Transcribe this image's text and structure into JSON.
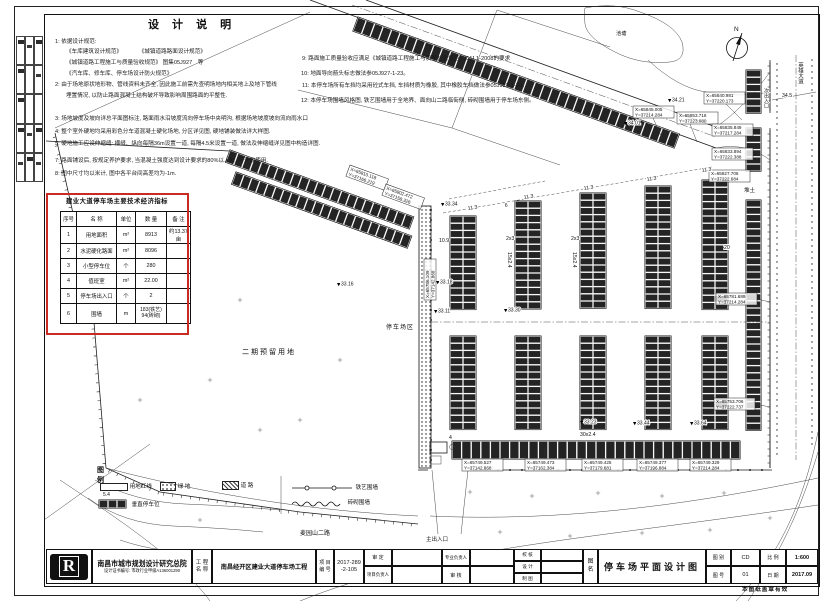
{
  "design_notes": {
    "title": "设 计 说 明",
    "left": [
      "1: 依据设计规范:",
      "《车库建筑设计规范》　　　　《城镇道路路面设计规范》",
      "《城镇道路工程施工与质量验收规范》 图集05J927　等",
      "《汽车库、修车库、停车场设计防火规范》",
      "2: 由于场地原状地形物、管线资料未齐全, 因此施工前需先查明场地内相关地上及地下管线",
      "埋置情况, 以防止路面混凝土结构破坏导致影响周围路面的平整性.",
      "3: 场地坡度及坡向详总平面图标注, 路面雨水沿坡度流向停车场中央明沟, 根据场地坡度坡向流向雨水口",
      "4: 整个室外硬地均采用彩色分车道混凝土硬化场地, 分区详见图, 硬地铺装做法详大样图.",
      "5: 硬地施工应设伸缩缝: 横缝、纵向每隔36m设置一道, 每隔4.5米设置一道, 做法及伸缩缝详见图中构造详图.",
      "7: 路面铺设后, 按规定养护要求, 当混凝土强度达到设计要求的80%以上时, 可开放使用.",
      "8: 图中尺寸均以米计, 图中各平台间高差均为-1m."
    ],
    "right": [
      "9: 路面施工质量验收应满足《城镇道路工程施工与质量验收规范》CJJ 1-2008的要求",
      "10: 地面导向箭头标志做法参05J927-1-23。",
      "11: 本停车场所有车挡均采用砼式车挡, 车挡材质为橡胶, 其中橡胶车挡做法参05J927-1-30。",
      "12: 本停车场围墙风格图, 铁艺围墙用于全地界、面向山二路临街侧, 砖砌围墙用于停车场东侧。"
    ]
  },
  "indicators": {
    "title": "建业大道停车场主要技术经济指标",
    "headers": [
      "序号",
      "名  称",
      "单位",
      "数 量",
      "备 注"
    ],
    "rows": [
      {
        "no": "1",
        "name": "用地面积",
        "unit": "m²",
        "qty": "8913",
        "qty2": "",
        "remark": "约13.37亩"
      },
      {
        "no": "2",
        "name": "水泥硬化路面",
        "unit": "m²",
        "qty": "8096",
        "qty2": "",
        "remark": ""
      },
      {
        "no": "3",
        "name": "小型停车位",
        "unit": "个",
        "qty": "280",
        "qty2": "",
        "remark": ""
      },
      {
        "no": "4",
        "name": "值班室",
        "unit": "m²",
        "qty": "22.00",
        "qty2": "",
        "remark": ""
      },
      {
        "no": "5",
        "name": "停车场出入口",
        "unit": "个",
        "qty": "2",
        "qty2": "",
        "remark": ""
      },
      {
        "no": "6",
        "name": "围墙",
        "unit": "m",
        "qty": "183(铁艺)",
        "qty2": "94(砖砌)",
        "remark": ""
      }
    ]
  },
  "legend": {
    "title": "图 例",
    "redline": "用地红线",
    "green": "绿  地",
    "road": "道  路",
    "stall": "垂直停车位",
    "stall_dim": "5.4",
    "iron": "铁艺围墙",
    "brick": "砖砌围墙"
  },
  "plan": {
    "labels": {
      "north": "N",
      "pond": "池塘",
      "pile": "堆土",
      "phase2": "二期预留用地",
      "zone": "停车场区",
      "main_entry": "主出入口",
      "sub_entry": "次出入口",
      "road_name": "英雄大道",
      "bottom_road": "麦园山二路"
    },
    "coords": {
      "t1x": "X=65845.005",
      "t1y": "Y=37214.284",
      "t2x": "X=65853.716",
      "t2y": "Y=37223.080",
      "t3x": "X=65840.981",
      "t3y": "Y=37220.173",
      "r1x": "X=65835.849",
      "r1y": "Y=37217.284",
      "r2x": "X=65833.894",
      "r2y": "Y=37222.388",
      "r3x": "X=65827.706",
      "r3y": "Y=37222.684",
      "r4x": "X=65781.689",
      "r4y": "Y=37214.284",
      "r5x": "X=65753.706",
      "r5y": "Y=37222.737",
      "b1x": "X=65749.527",
      "b1y": "Y=37142.868",
      "b2x": "X=65749.473",
      "b2y": "Y=37162.384",
      "b3x": "X=65749.425",
      "b3y": "Y=37179.681",
      "b4x": "X=65749.377",
      "b4y": "Y=37196.884",
      "b5x": "X=65749.329",
      "b5y": "Y=37214.284",
      "l1x": "X=65786.109",
      "l1y": "Y=37142.868",
      "d1x": "X=65810.118",
      "d1y": "Y=37166.219",
      "d2x": "X=65802.472",
      "d2y": "Y=37158.326"
    },
    "elevations": {
      "e1": "33.34",
      "e2": "33.18",
      "e3": "33.11",
      "e4": "33.16",
      "e5": "33.23",
      "e6": "33.44",
      "e7": "33.64",
      "e8": "34.21",
      "e9": "34.01",
      "e10": "33.30"
    },
    "dims": {
      "m1": "11.3",
      "m2": "11.3",
      "m3": "11.3",
      "m4": "11.3",
      "m5": "11.3",
      "a1": "10.9",
      "a2": "6",
      "a3": "2x3",
      "a4": "2x3",
      "v1": "15x2.4",
      "v2": "15x2.4",
      "h1": "30x2.4",
      "rw": "34.5",
      "g1": "20",
      "g2": "4"
    }
  },
  "title_block": {
    "company": "南昌市城市规划设计研究总院",
    "cert": "设计证书编号: 市政行业甲级A136001290",
    "logo_text": "R",
    "pl1": "工 程",
    "pl2": "名 称",
    "project_name": "南昌经开区建业大道停车场工程",
    "nl1": "项 目",
    "nl2": "编 号",
    "project_no1": "2017-289",
    "project_no2": "-2-105",
    "approve": "审  定",
    "pm": "项目负责人",
    "lead": "专业负责人",
    "check": "审  核",
    "proof": "校 核",
    "design": "设 计",
    "draft": "制 图",
    "dn1": "图",
    "dn2": "名",
    "drawing_name": "停车场平面设计图",
    "cat_label": "图 别",
    "cat": "CD",
    "scale_label": "比 例",
    "scale": "1:600",
    "no_label": "图 号",
    "no": "01",
    "date_label": "日 期",
    "date": "2017.09",
    "stamp": "本图纸盖章有效"
  }
}
